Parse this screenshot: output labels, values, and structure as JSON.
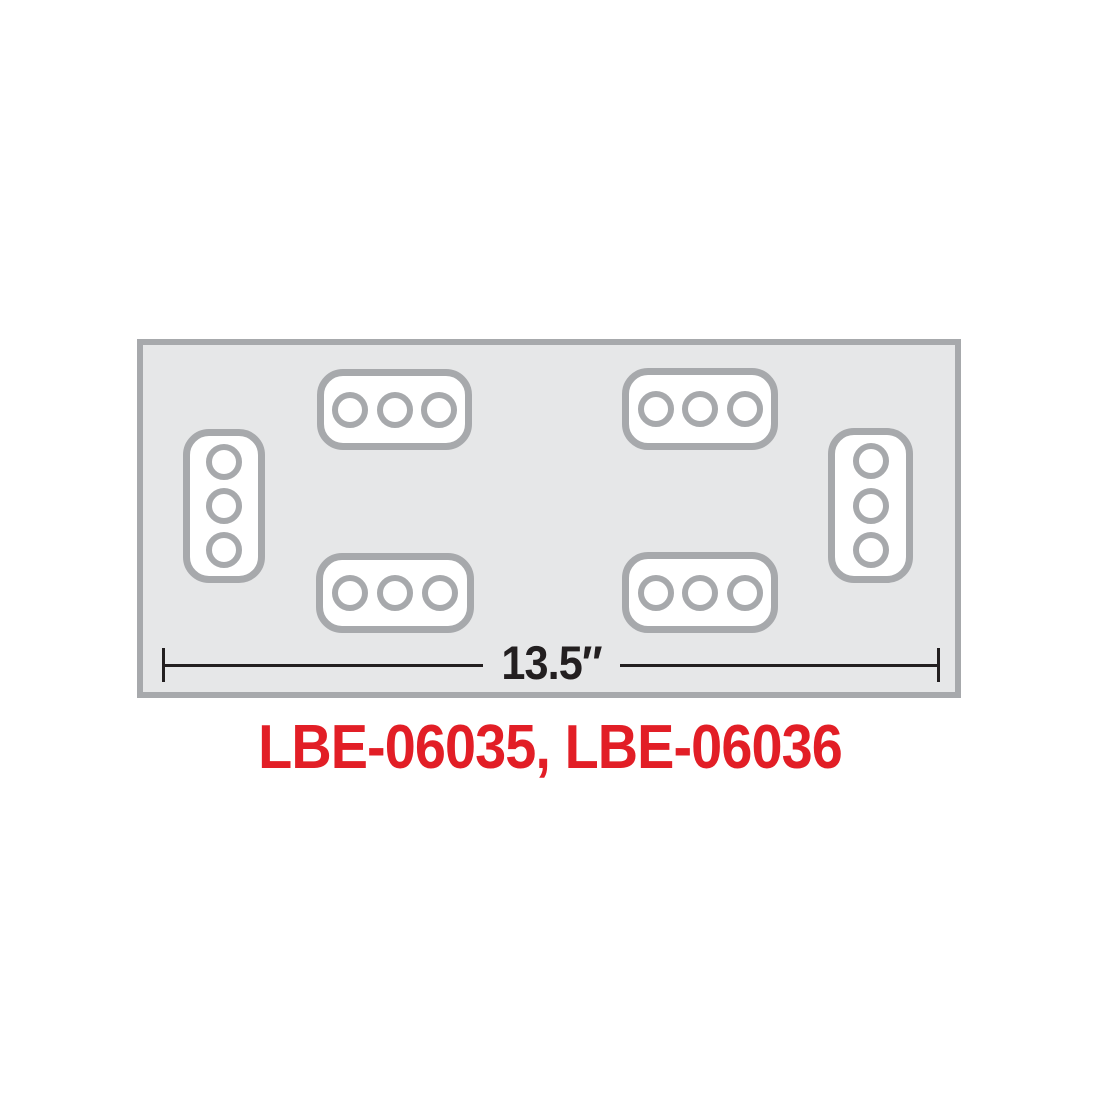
{
  "diagram": {
    "dimension": {
      "label": "13.5″"
    },
    "part_numbers": "LBE-06035, LBE-06036",
    "panel": {
      "shape": "rectangle",
      "lamp_clusters": [
        {
          "position": "top-left",
          "orientation": "horizontal",
          "lamp_count": 3
        },
        {
          "position": "top-right",
          "orientation": "horizontal",
          "lamp_count": 3
        },
        {
          "position": "bottom-left",
          "orientation": "horizontal",
          "lamp_count": 3
        },
        {
          "position": "bottom-right",
          "orientation": "horizontal",
          "lamp_count": 3
        },
        {
          "position": "left-edge",
          "orientation": "vertical",
          "lamp_count": 3
        },
        {
          "position": "right-edge",
          "orientation": "vertical",
          "lamp_count": 3
        }
      ]
    }
  },
  "colors": {
    "background": "#FFFFFF",
    "panel_fill": "#E6E7E8",
    "outline_gray": "#A7A9AC",
    "dimension_line": "#231F20",
    "part_number_red": "#E21E26"
  }
}
